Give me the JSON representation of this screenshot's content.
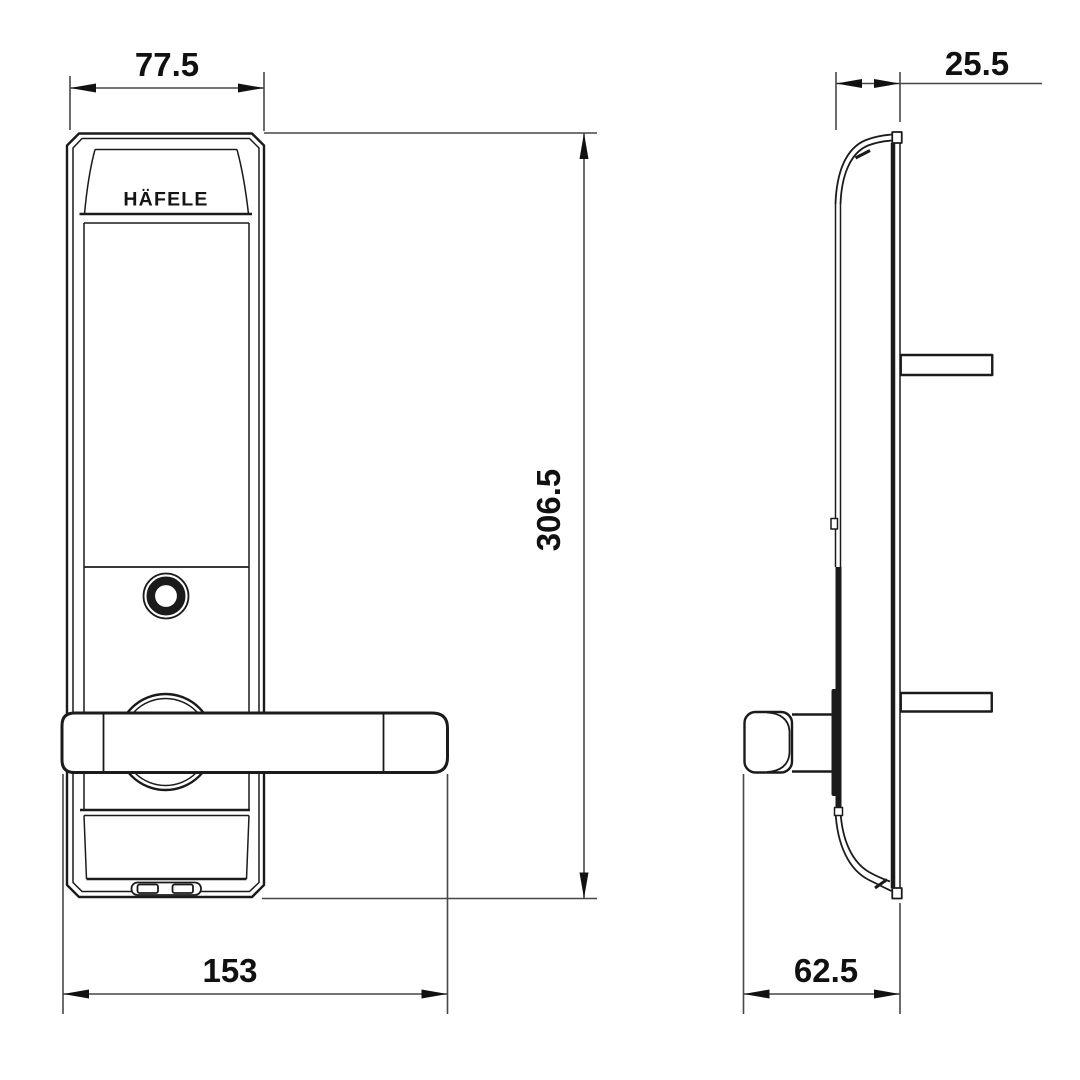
{
  "brand": "HÄFELE",
  "drawing": {
    "type": "technical-dimension-drawing",
    "subject": "digital door lock, front view and side view",
    "line_color": "#1b1b1b",
    "background": "#ffffff"
  },
  "dimensions": {
    "front_top_width": "77.5",
    "overall_height": "306.5",
    "front_overall_width": "153",
    "side_top_depth": "25.5",
    "side_overall_depth": "62.5"
  }
}
